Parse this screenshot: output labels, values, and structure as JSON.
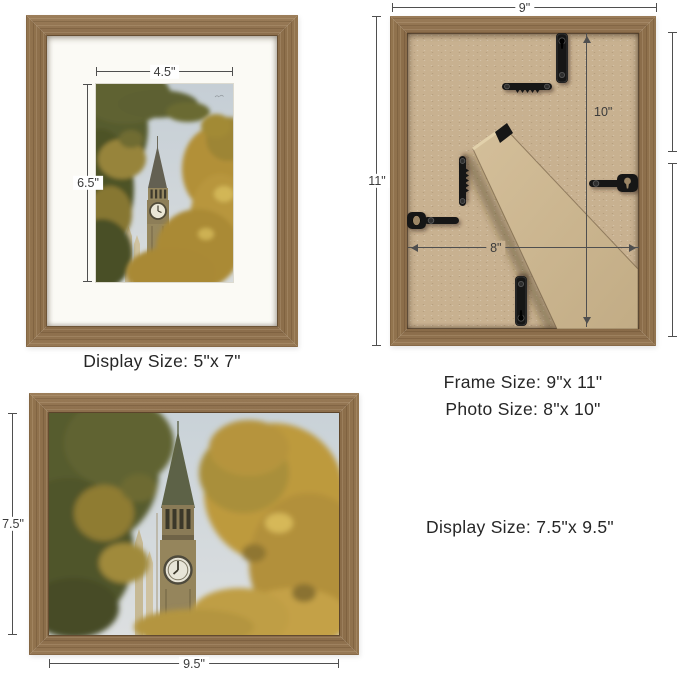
{
  "frames": {
    "front_small": {
      "width_label": "4.5\"",
      "height_label": "6.5\"",
      "caption": "Display Size: 5\"x 7\""
    },
    "back": {
      "outer_width_label": "9\"",
      "outer_height_label": "11\"",
      "photo_height_label": "10\"",
      "photo_width_label": "8\"",
      "caption_frame_size": "Frame Size: 9\"x 11\"",
      "caption_photo_size": "Photo Size: 8\"x 10\""
    },
    "front_large": {
      "height_label": "7.5\"",
      "width_label": "9.5\"",
      "caption": "Display Size: 7.5\"x 9.5\""
    }
  },
  "colors": {
    "wood": "#8f7250",
    "mat": "#fbfaf5",
    "mdf_backing": "#c8b190",
    "hardware": "#191919",
    "dimension_line": "#4f4f4f",
    "text": "#262626",
    "background": "#ffffff"
  }
}
